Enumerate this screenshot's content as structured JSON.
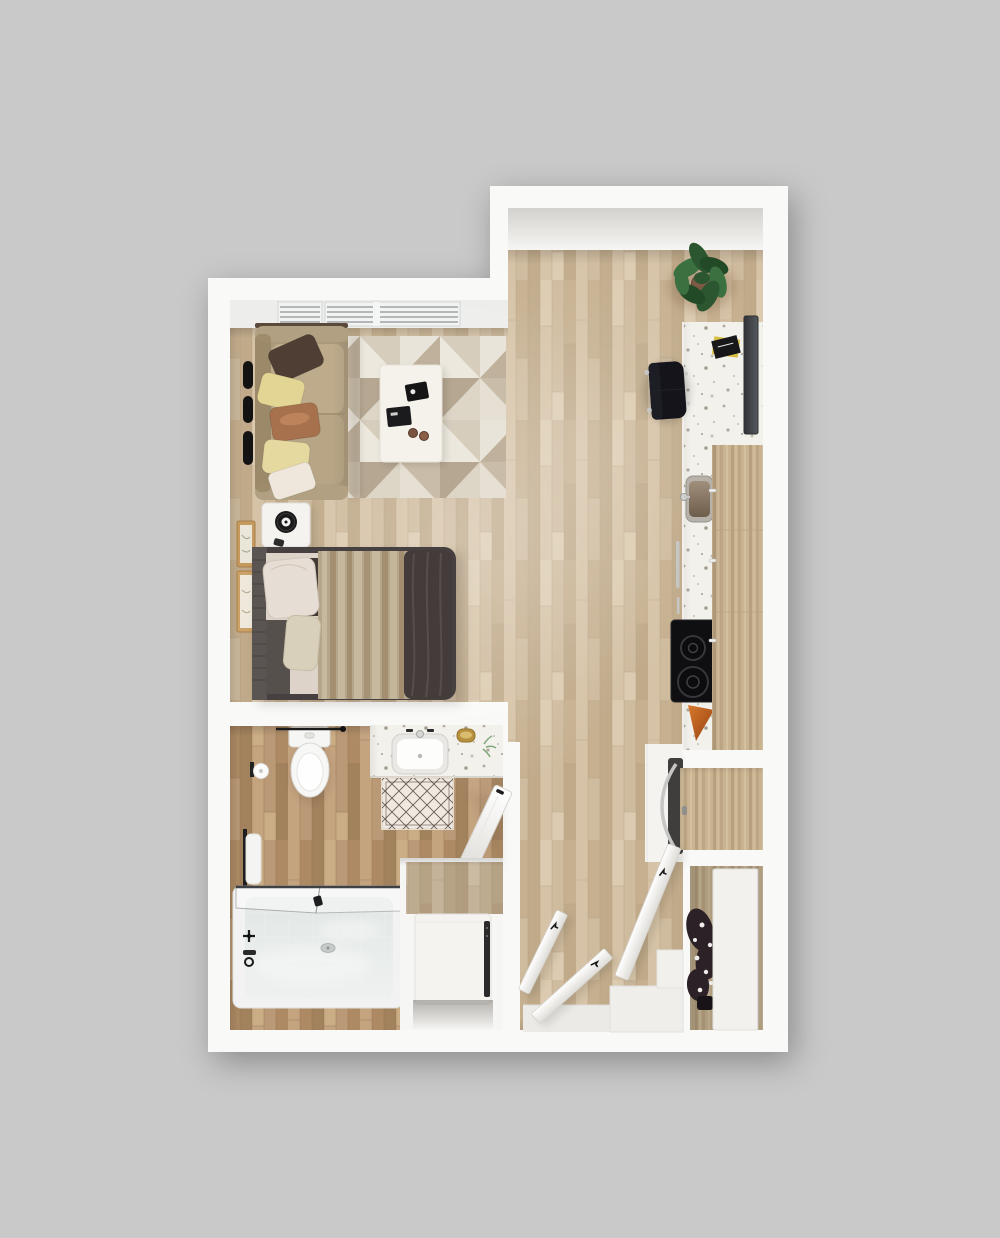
{
  "meta": {
    "title": "Studio apartment floor plan - 3D top-down render",
    "render_style": "photoreal top view, no text labels"
  },
  "palette": {
    "bg": "#c9c9c9",
    "wall": "#f9f9f7",
    "wallShade": "#e7e6e3",
    "ceil": "#d3d1cd",
    "sill": "#edeeec",
    "winSlat": "#8e9194",
    "woodBase": "#ccb698",
    "wood1": "#d6c3a7",
    "wood2": "#c6b090",
    "wood3": "#cfbb9e",
    "wood4": "#c0aa8a",
    "wood5": "#dccbb0",
    "woodSep": "#b49c7b",
    "bathBase": "#b6946f",
    "bath1": "#c4a37f",
    "bath2": "#ad8a64",
    "bath3": "#ba9976",
    "bath4": "#a2815d",
    "bath5": "#caac85",
    "bathSep": "#8d6f51",
    "cabBase": "#c9b391",
    "cab1": "#bda684",
    "cab2": "#d2c09f",
    "cab3": "#b7a07e",
    "cab4": "#cfbc9b",
    "terrBase": "#f3f1eb",
    "terrDot1": "#b3aa9d",
    "terrDot2": "#a79d8f",
    "terrDot3": "#cfc8bb",
    "terrDot4": "#c7bfb2",
    "rug1": "#e9e4d9",
    "rug2": "#bfb19c",
    "rug3": "#d6cdbd",
    "rug4": "#ece8de",
    "rug5": "#c9bca8",
    "rug6": "#e6e0d4",
    "rug7": "#b5a791",
    "rug8": "#ddd5c6",
    "sofaBody": "#ab997b",
    "sofaArm": "#b1a081",
    "sofaCushion": "#bdab8b",
    "sofaCushion2": "#b7a585",
    "sofaDark": "#93815f",
    "sofaTrim": "#5b4a3a",
    "pillowBrown": "#4e3e34",
    "pillowYellow": "#e3d594",
    "pillowYellow2": "#e6d9a0",
    "pillowCopper": "#a8714e",
    "pillowCopperHi": "#c28a60",
    "pillowCream": "#efe7dc",
    "tableWhite": "#f5f2ec",
    "trayBlack": "#151515",
    "bedFrame": "#474040",
    "headboard": "#5a5452",
    "duvet": "#443c3b",
    "duvetFold": "#5d5350",
    "blanket": "#b5a68b",
    "blanketHi": "#c7b99d",
    "blanketLo": "#a38f70",
    "sheet": "#ddd3c8",
    "bedCorner": "#56504c",
    "bedPillow1": "#e6ddd4",
    "bedPillow2": "#d9d0bb",
    "fixtureWhite": "#f6f6f4",
    "fixtureLine": "#d9d9d6",
    "tubRim": "#f1f2f1",
    "tubA": "#e2e7e5",
    "tubB": "#eef1f0",
    "glassFrame": "#3f4144",
    "matBase": "#efe9e1",
    "matLine": "#46382e",
    "gold": "#b5913f",
    "goldHi": "#d9bc6d",
    "towelWhite": "#f4f4f2",
    "black": "#161616",
    "chrome": "#c6c6c4",
    "tvA": "#303237",
    "tvB": "#55585e",
    "chairBlack": "#14141a",
    "sinkRim": "#b6b2aa",
    "basinA": "#a08f7b",
    "basinB": "#6d5d4b",
    "cookBlack": "#0f0f12",
    "burner": "#36363b",
    "orangeA": "#d9782e",
    "orangeB": "#93420f",
    "doorA": "#ffffff",
    "doorB": "#dedcd7",
    "doorEdge": "#d6d4cf",
    "applWhite": "#f4f3f0",
    "applSlit": "#2b2b2e",
    "applDark": "#3f3e3c",
    "plantG1": "#2c5630",
    "plantG2": "#3b7040",
    "plantG3": "#234a27",
    "plantPot": "#7d5a44",
    "plantShade": "#6b4a2f",
    "darkPlant": "#2b2127",
    "darkPlantHi": "#efecea",
    "stepWhite": "#efeeea",
    "threshold": "#ebeae6"
  },
  "rooms": [
    {
      "id": "living-area",
      "label": "Living / Sleeping Area",
      "furniture": [
        "window-blinds",
        "sofa",
        "throw-pillows-x5",
        "wall-mounted-bars",
        "area-rug-geometric",
        "coffee-table",
        "serving-tray",
        "coffee-cups",
        "nightstand",
        "alarm-clock",
        "wall-art-frames",
        "queen-bed",
        "bed-pillows",
        "blanket",
        "dark-duvet"
      ]
    },
    {
      "id": "kitchen",
      "label": "Kitchen",
      "furniture": [
        "terrazzo-counter",
        "wall-tv",
        "cookbook",
        "desk-chair",
        "kitchen-sink",
        "dishwasher-handle",
        "cooktop-2-burner",
        "oven-mitt",
        "upper-cabinets",
        "refrigerator",
        "potted-plant"
      ]
    },
    {
      "id": "bathroom",
      "label": "Bathroom",
      "furniture": [
        "toilet",
        "towel-bar",
        "toilet-paper-holder",
        "vanity-counter",
        "vanity-sink",
        "soap-dish-gold",
        "small-plant",
        "bath-mat-lattice",
        "grab-bar-towel",
        "bathroom-door",
        "bathtub",
        "glass-shower-screen",
        "tub-faucet",
        "washer-dryer"
      ]
    },
    {
      "id": "entry-hall",
      "label": "Entry Hall",
      "furniture": [
        "open-door-leaf-1",
        "open-door-leaf-2",
        "open-door-leaf-3",
        "threshold",
        "step-platform"
      ]
    },
    {
      "id": "closets",
      "label": "Closets",
      "furniture": [
        "wardrobe-cabinet",
        "closet-back-panel",
        "sliding-panel",
        "dried-plant-arrangement"
      ]
    }
  ]
}
